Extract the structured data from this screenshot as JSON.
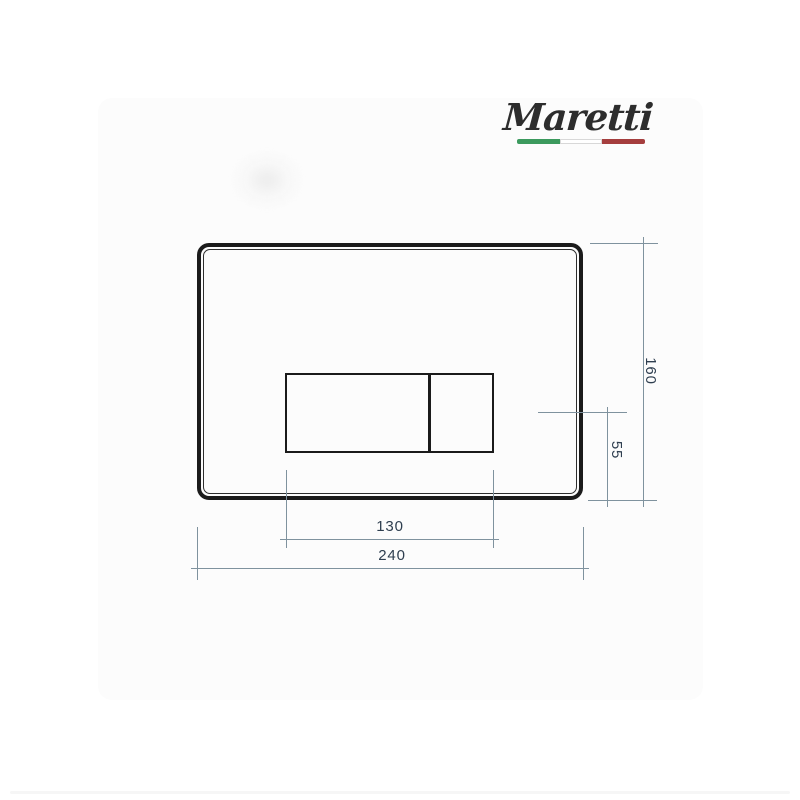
{
  "theme": {
    "page-bg": "#ffffff",
    "card-bg": "#fcfcfc",
    "plate-border-color": "#1b1b1b",
    "line-color": "#7f929e",
    "dim-text-color": "#2e3e4f",
    "logo-color": "#2d2d2d",
    "flag-green": "#3c9a5e",
    "flag-red": "#a53e3e"
  },
  "brand": {
    "name": "Maretti",
    "flag_icon": "italian-flag-stripe"
  },
  "dims": {
    "plate_height_mm": "160",
    "button_center_to_bottom_mm": "55",
    "buttons_width_mm": "130",
    "plate_width_mm": "240"
  },
  "drawing": {
    "object": "toilet flush plate, front view technical drawing",
    "annotations": [
      {
        "value": "160",
        "orientation": "vertical"
      },
      {
        "value": "55",
        "orientation": "vertical"
      },
      {
        "value": "130",
        "orientation": "horizontal"
      },
      {
        "value": "240",
        "orientation": "horizontal"
      }
    ]
  }
}
